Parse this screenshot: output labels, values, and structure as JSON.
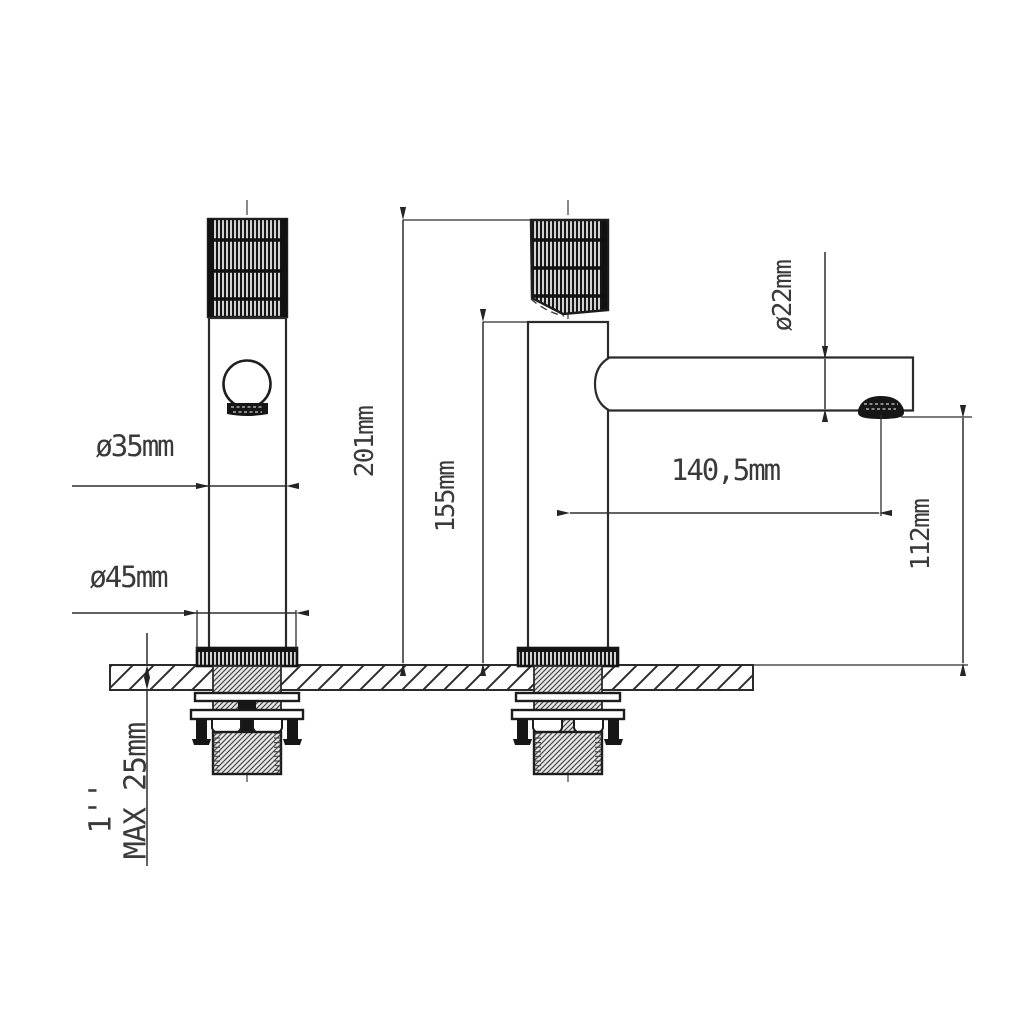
{
  "drawing": {
    "type": "technical-drawing-faucet",
    "views": {
      "front_view": {
        "labels": {
          "handle_diameter": "ø35mm",
          "base_diameter": "ø45mm",
          "counter_max_thickness": "MAX 25mm",
          "thread_size": "1''"
        }
      },
      "side_view": {
        "labels": {
          "total_height": "201mm",
          "height_to_spout_top": "155mm",
          "spout_diameter": "ø22mm",
          "spout_reach": "140,5mm",
          "spout_height": "112mm"
        }
      }
    },
    "colors": {
      "line": "#2b2b2b",
      "background": "#ffffff"
    }
  }
}
